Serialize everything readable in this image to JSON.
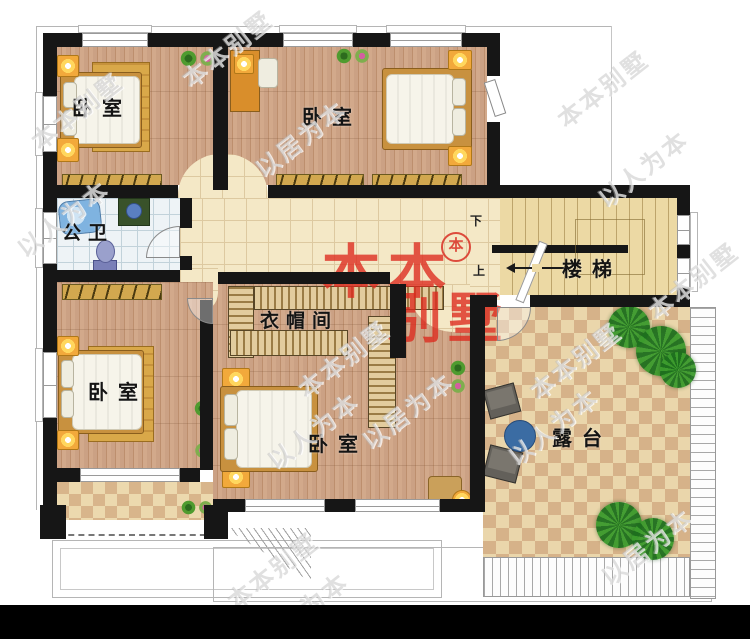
{
  "rooms": {
    "bedroom_top_left": {
      "label": "卧室"
    },
    "bedroom_top_right": {
      "label": "卧室"
    },
    "bathroom": {
      "label": "公卫"
    },
    "stairs": {
      "label": "楼梯",
      "down": "下",
      "up": "上"
    },
    "closet": {
      "label": "衣帽间"
    },
    "bedroom_bottom_left": {
      "label": "卧室"
    },
    "bedroom_bottom_middle": {
      "label": "卧室"
    },
    "terrace": {
      "label": "露台"
    }
  },
  "watermarks": {
    "brand": "本本别墅",
    "slogan_people": "以人为本",
    "slogan_home": "以居为本",
    "logo_top": "本本",
    "logo_bottom": "别墅",
    "stamp": "本"
  },
  "footer": {
    "text": "本图编号:A001  版权所有,盗图必究 （湘作登字2016-L-2015）  18607320447  本本别墅专业承接私宅设计"
  },
  "colors": {
    "wall": "#161616",
    "red_logo": "#dd2a1e",
    "wood_floor": "#c9a181",
    "corridor_tile": "#f4e8c6",
    "checker_dark": "#d6b289",
    "footer_bg": "#000000"
  }
}
